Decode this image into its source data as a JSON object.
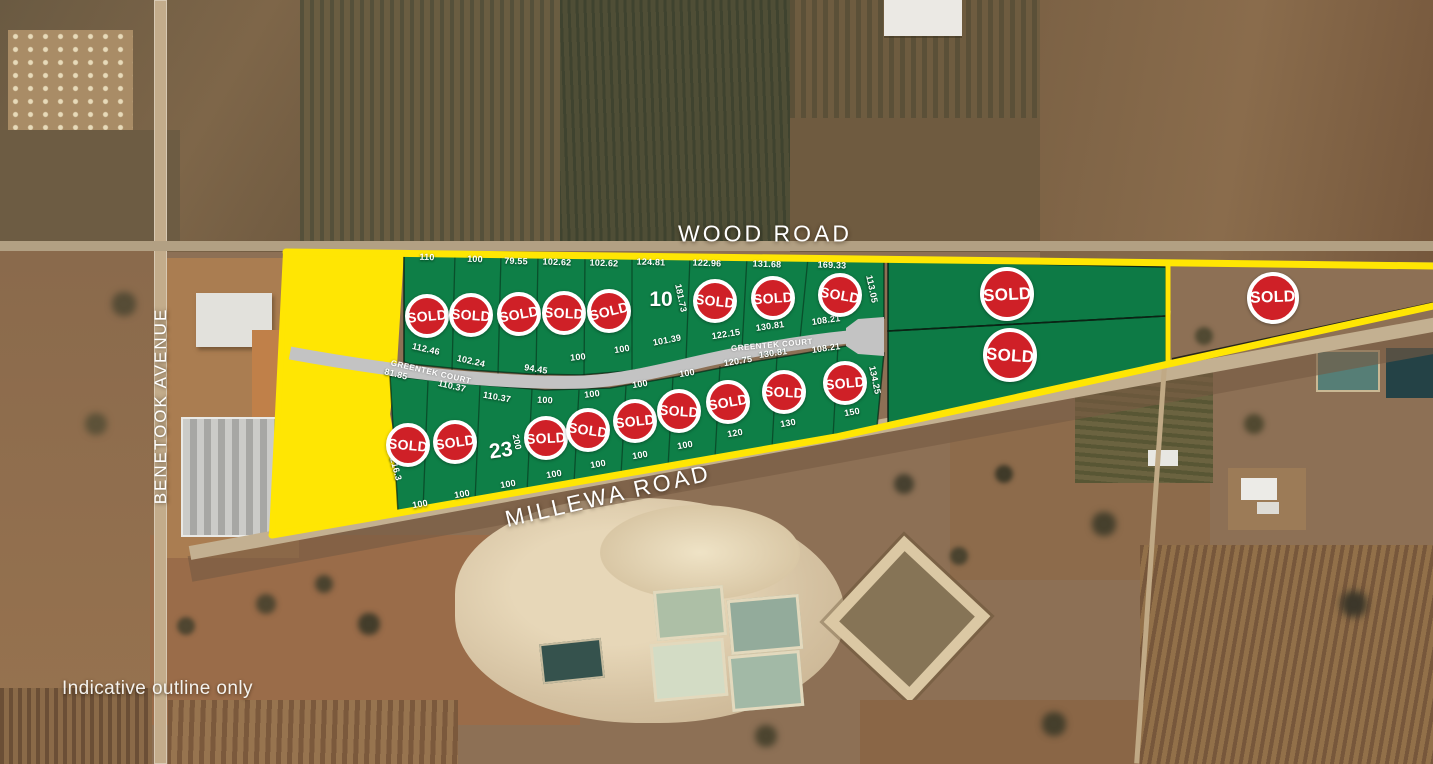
{
  "map": {
    "disclaimer": "Indicative outline only",
    "sold_label": "SOLD",
    "roads": {
      "wood": "WOOD ROAD",
      "millewa": "MILLEWA ROAD",
      "benetook": "BENETOOK AVENUE",
      "greentek": "GREENTEK COURT"
    },
    "colors": {
      "boundary_yellow": "#ffe603",
      "lot_green": "#0e7f47",
      "sold_red": "#cf2027",
      "road_gray": "#c3c3c3",
      "label_white": "#ffffff"
    }
  },
  "lots": {
    "top_row": [
      {
        "top": {
          "t": "110",
          "p": [
            427,
            257,
            2
          ]
        },
        "bottom": {
          "t": "112.46",
          "p": [
            426,
            349,
            13
          ]
        },
        "sold": true,
        "badge": [
          427,
          316,
          22,
          -5
        ]
      },
      {
        "top": {
          "t": "100",
          "p": [
            475,
            259,
            2
          ]
        },
        "bottom": {
          "t": "102.24",
          "p": [
            471,
            361,
            13
          ]
        },
        "sold": true,
        "badge": [
          471,
          315,
          22,
          4
        ]
      },
      {
        "top": {
          "t": "79.55",
          "p": [
            516,
            261,
            2
          ]
        },
        "bottom": {
          "t": "94.45",
          "p": [
            536,
            369,
            9
          ]
        },
        "sold": true,
        "badge": [
          519,
          314,
          22,
          -10
        ]
      },
      {
        "top": {
          "t": "102.62",
          "p": [
            557,
            262,
            2
          ]
        },
        "bottom": {
          "t": "100",
          "p": [
            578,
            357,
            -6
          ]
        },
        "sold": true,
        "badge": [
          564,
          313,
          22,
          3
        ]
      },
      {
        "top": {
          "t": "102.62",
          "p": [
            604,
            263,
            2
          ]
        },
        "bottom": {
          "t": "100",
          "p": [
            622,
            349,
            -9
          ]
        },
        "sold": true,
        "badge": [
          609,
          311,
          22,
          -14
        ]
      },
      {
        "top": {
          "t": "124.81",
          "p": [
            651,
            262,
            2
          ]
        },
        "bottom": {
          "t": "101.39",
          "p": [
            667,
            340,
            -11
          ]
        },
        "number": {
          "t": "10",
          "p": [
            661,
            300,
            0
          ]
        },
        "side": {
          "t": "181.73",
          "p": [
            681,
            298,
            78
          ]
        },
        "sold": false
      },
      {
        "top": {
          "t": "122.96",
          "p": [
            707,
            263,
            2
          ]
        },
        "bottom": {
          "t": "122.15",
          "p": [
            726,
            334,
            -9
          ]
        },
        "sold": true,
        "badge": [
          715,
          301,
          22,
          6
        ]
      },
      {
        "top": {
          "t": "131.68",
          "p": [
            767,
            264,
            2
          ]
        },
        "bottom": {
          "t": "130.81",
          "p": [
            770,
            326,
            -8
          ]
        },
        "sold": true,
        "badge": [
          773,
          298,
          22,
          -4
        ]
      },
      {
        "top": {
          "t": "169.33",
          "p": [
            832,
            265,
            2
          ]
        },
        "bottom": {
          "t": "108.21",
          "p": [
            826,
            320,
            -8
          ]
        },
        "side": {
          "t": "113.05",
          "p": [
            872,
            289,
            78
          ]
        },
        "sold": true,
        "badge": [
          840,
          295,
          22,
          10
        ]
      }
    ],
    "bottom_row": [
      {
        "top": {
          "t": "81.85",
          "p": [
            396,
            374,
            14
          ]
        },
        "bottom": {
          "t": "100",
          "p": [
            420,
            504,
            -10
          ]
        },
        "side": {
          "t": "216.3",
          "p": [
            396,
            469,
            75
          ]
        },
        "sold": true,
        "badge": [
          408,
          445,
          22,
          5
        ]
      },
      {
        "top": {
          "t": "110.37",
          "p": [
            452,
            386,
            13
          ]
        },
        "bottom": {
          "t": "100",
          "p": [
            462,
            494,
            -10
          ]
        },
        "sold": true,
        "badge": [
          455,
          442,
          22,
          -8
        ]
      },
      {
        "top": {
          "t": "110.37",
          "p": [
            497,
            397,
            10
          ]
        },
        "bottom": {
          "t": "100",
          "p": [
            508,
            484,
            -10
          ]
        },
        "number": {
          "t": "23",
          "p": [
            501,
            451,
            -8
          ]
        },
        "side": {
          "t": "200",
          "p": [
            517,
            442,
            78
          ]
        },
        "sold": false
      },
      {
        "top": {
          "t": "100",
          "p": [
            545,
            400,
            3
          ]
        },
        "bottom": {
          "t": "100",
          "p": [
            554,
            474,
            -10
          ]
        },
        "sold": true,
        "badge": [
          546,
          438,
          22,
          -3
        ]
      },
      {
        "top": {
          "t": "100",
          "p": [
            592,
            394,
            -7
          ]
        },
        "bottom": {
          "t": "100",
          "p": [
            598,
            464,
            -10
          ]
        },
        "sold": true,
        "badge": [
          588,
          430,
          22,
          8
        ]
      },
      {
        "top": {
          "t": "100",
          "p": [
            640,
            384,
            -9
          ]
        },
        "bottom": {
          "t": "100",
          "p": [
            640,
            455,
            -10
          ]
        },
        "sold": true,
        "badge": [
          635,
          421,
          22,
          -6
        ]
      },
      {
        "top": {
          "t": "100",
          "p": [
            687,
            373,
            -9
          ]
        },
        "bottom": {
          "t": "100",
          "p": [
            685,
            445,
            -10
          ]
        },
        "sold": true,
        "badge": [
          679,
          411,
          22,
          4
        ]
      },
      {
        "top": {
          "t": "120.75",
          "p": [
            738,
            361,
            -9
          ]
        },
        "bottom": {
          "t": "120",
          "p": [
            735,
            433,
            -10
          ]
        },
        "sold": true,
        "badge": [
          728,
          402,
          22,
          -10
        ]
      },
      {
        "top": {
          "t": "130.81",
          "p": [
            773,
            353,
            -8
          ]
        },
        "bottom": {
          "t": "130",
          "p": [
            788,
            423,
            -10
          ]
        },
        "sold": true,
        "badge": [
          784,
          392,
          22,
          3
        ]
      },
      {
        "top": {
          "t": "108.21",
          "p": [
            826,
            348,
            -8
          ]
        },
        "bottom": {
          "t": "150",
          "p": [
            852,
            412,
            -10
          ]
        },
        "side": {
          "t": "134.25",
          "p": [
            875,
            380,
            78
          ]
        },
        "sold": true,
        "badge": [
          845,
          383,
          22,
          -5
        ]
      }
    ],
    "large_east": [
      {
        "sold": true,
        "badge": [
          1007,
          294,
          27,
          -3
        ]
      },
      {
        "sold": true,
        "badge": [
          1010,
          355,
          27,
          4
        ]
      }
    ],
    "far_east_wedge": {
      "sold": true,
      "badge": [
        1273,
        298,
        26,
        -2
      ]
    }
  }
}
